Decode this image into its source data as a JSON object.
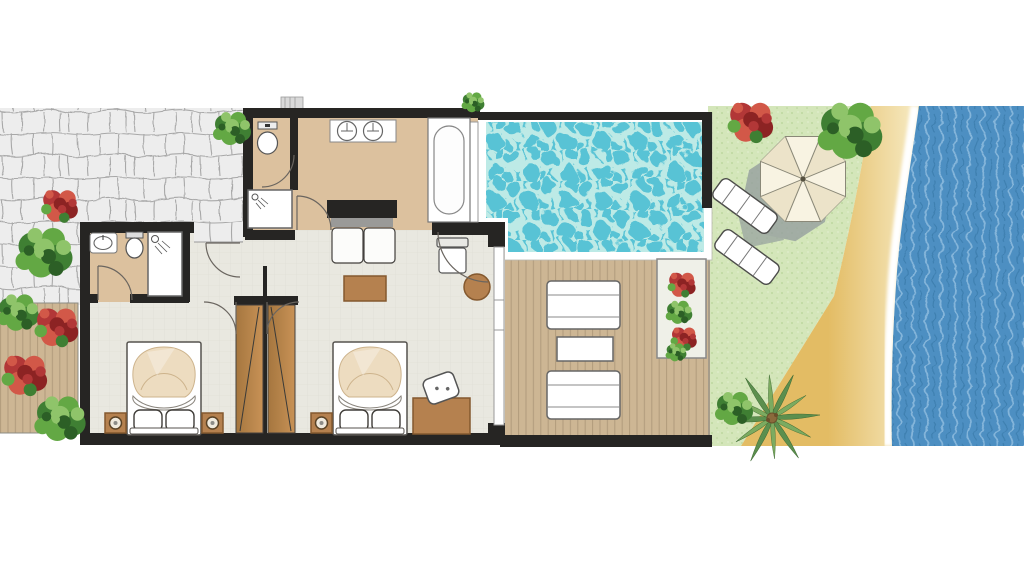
{
  "document": {
    "kind": "architectural-floor-plan",
    "scene": "beachfront villa suite with private pool, wooden sun deck, lawn garden and sea shore"
  },
  "palette": {
    "wall": "#262523",
    "stone": "#ededed",
    "stoneLine": "#a8a8a8",
    "bath": "#dcc19e",
    "floor": "#e9e8e0",
    "floorLine": "#dddcd3",
    "deck": "#cdb694",
    "deckLine": "#b19b7c",
    "pool": "#58c3d5",
    "poolLight": "#c9efe8",
    "sea": "#4d8fc2",
    "seaLight": "#8fbcdf",
    "seaDark": "#3a79a9",
    "sand": "#e3bc64",
    "sandLight": "#f6e9c0",
    "lawn": "#d4e6ba",
    "lawnDot": "#b7d498",
    "wood": "#b5814f",
    "woodDark": "#84592f",
    "line": "#4f4b47",
    "blanket": "#eddcc0",
    "blanketLine": "#cdb38c",
    "umbrella": "#f8f3e2",
    "umbrellaAlt": "#ece3c9",
    "shadow": "#96a09f",
    "foam": "#ffffff",
    "green1": "#3f7f33",
    "green2": "#63a844",
    "green3": "#8fc46a",
    "green4": "#2c5f26",
    "red1": "#b23737",
    "red2": "#d25848",
    "red3": "#8c2323",
    "palmA": "#5c8f4e",
    "palmB": "#7cab60",
    "trunk": "#8a6a3c"
  },
  "areas": [
    "stone-patio",
    "entry-alcove",
    "main-bathroom",
    "wc",
    "en-suite-bathroom",
    "living-area",
    "bedroom-left",
    "bedroom-right",
    "wardrobe-hallway",
    "private-pool",
    "pool-deck",
    "side-walkway-deck",
    "lawn-garden",
    "sandy-beach",
    "sea"
  ],
  "fixtures": [
    {
      "name": "double-bed",
      "count": 2
    },
    {
      "name": "pillow",
      "count": 4
    },
    {
      "name": "nightstand-with-lamp",
      "count": 3
    },
    {
      "name": "wardrobe",
      "count": 2
    },
    {
      "name": "sofa",
      "count": 1
    },
    {
      "name": "coffee-table",
      "count": 1
    },
    {
      "name": "armchair",
      "count": 1
    },
    {
      "name": "round-stool",
      "count": 1
    },
    {
      "name": "desk",
      "count": 1
    },
    {
      "name": "desk-chair",
      "count": 1
    },
    {
      "name": "bathtub",
      "count": 1
    },
    {
      "name": "double-washbasin",
      "count": 1
    },
    {
      "name": "washbasin",
      "count": 1
    },
    {
      "name": "toilet",
      "count": 2
    },
    {
      "name": "shower",
      "count": 2
    },
    {
      "name": "pool",
      "count": 1
    },
    {
      "name": "deck-sun-lounger",
      "count": 2
    },
    {
      "name": "deck-side-table",
      "count": 1
    },
    {
      "name": "beach-sun-lounger",
      "count": 2
    },
    {
      "name": "parasol",
      "count": 1
    },
    {
      "name": "flower-planter",
      "count": 1
    },
    {
      "name": "palm-tree",
      "count": 1
    },
    {
      "name": "shrub",
      "count": 11
    }
  ]
}
